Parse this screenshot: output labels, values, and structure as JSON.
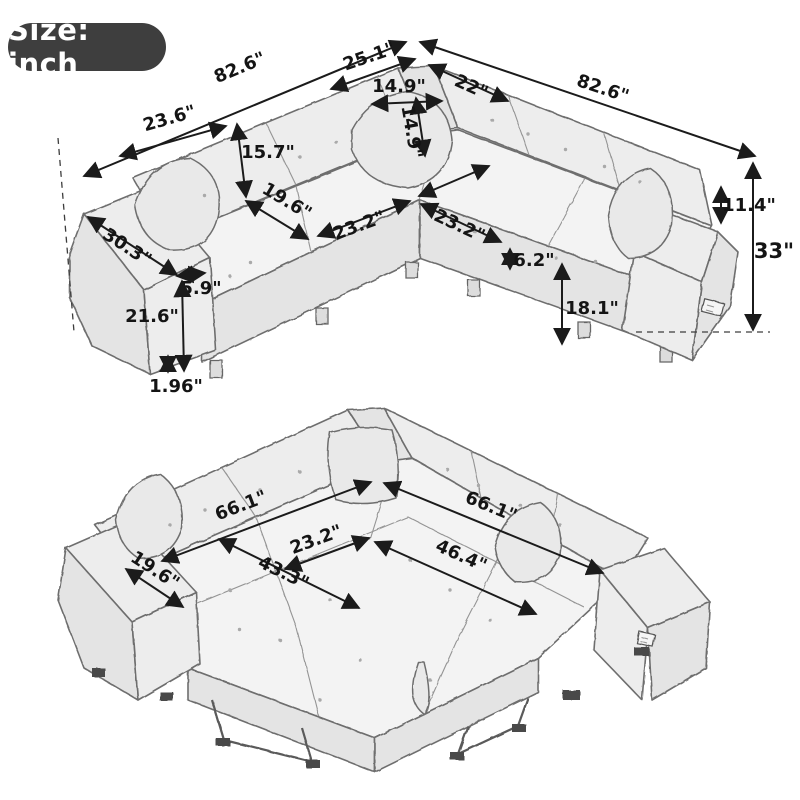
{
  "badge": {
    "label": "Size: inch"
  },
  "views": {
    "sofa": {
      "name": "sectional sofa assembled view",
      "dims": {
        "back_left": "82.6\"",
        "corner_back": "25.1\"",
        "pillow_w": "14.9\"",
        "pillow_h": "14.9\"",
        "right_back_first": "22\"",
        "back_right": "82.6\"",
        "back_cushion_w": "23.6\"",
        "back_h": "15.7\"",
        "seat_depth": "19.6\"",
        "seat_w_left": "23.2\"",
        "seat_w_right": "23.2\"",
        "arm_slope": "30.3\"",
        "arm_w": "5.9\"",
        "arm_h": "21.6\"",
        "leg_h": "1.96\"",
        "back_above_arm": "11.4\"",
        "total_h": "33\"",
        "cushion_t": "6.2\"",
        "seat_floor_h": "18.1\""
      }
    },
    "bed": {
      "name": "sectional sofa bed open view",
      "dims": {
        "left_len": "66.1\"",
        "right_len": "66.1\"",
        "center_w": "23.2\"",
        "right_pullout": "46.4\"",
        "left_pullout": "43.3\"",
        "arm_depth": "19.6\""
      }
    }
  }
}
